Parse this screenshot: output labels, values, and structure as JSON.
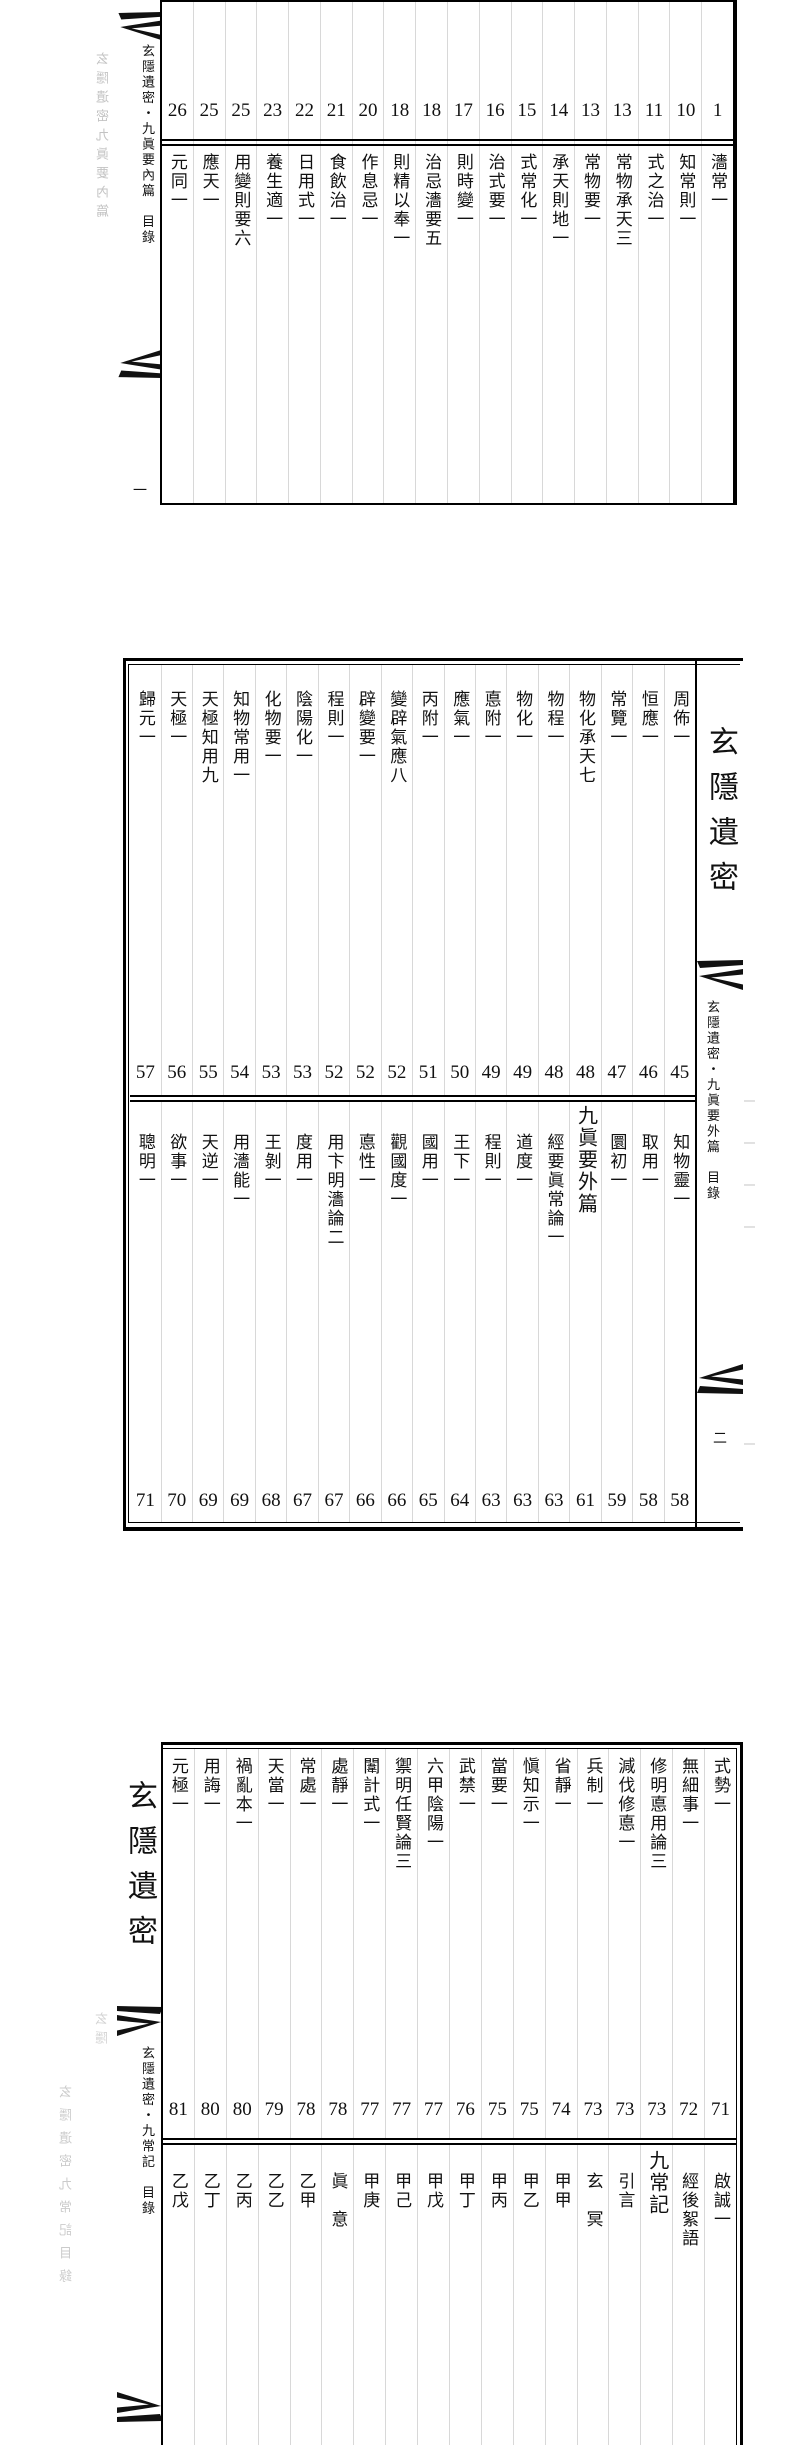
{
  "page": {
    "background": "#ffffff",
    "ink_color": "#111111",
    "grid_color": "#d8d8d8"
  },
  "section1": {
    "fold": {
      "title": "玄隱遺密・九眞要內篇　目錄",
      "folio": "一",
      "ghost_text": "玄隱遺密九眞要內篇"
    },
    "entries": [
      {
        "page": "1",
        "title": "瀒常一"
      },
      {
        "page": "10",
        "title": "知常則一"
      },
      {
        "page": "11",
        "title": "式之治一"
      },
      {
        "page": "13",
        "title": "常物承天三"
      },
      {
        "page": "13",
        "title": "常物要一"
      },
      {
        "page": "14",
        "title": "承天則地一"
      },
      {
        "page": "15",
        "title": "式常化一"
      },
      {
        "page": "16",
        "title": "治式要一"
      },
      {
        "page": "17",
        "title": "則時變一"
      },
      {
        "page": "18",
        "title": "治忌瀒要五"
      },
      {
        "page": "18",
        "title": "則精以奉一"
      },
      {
        "page": "20",
        "title": "作息忌一"
      },
      {
        "page": "21",
        "title": "食飲治一"
      },
      {
        "page": "22",
        "title": "日用式一"
      },
      {
        "page": "23",
        "title": "養生適一"
      },
      {
        "page": "25",
        "title": "用變則要六"
      },
      {
        "page": "25",
        "title": "應天一"
      },
      {
        "page": "26",
        "title": "元同一"
      }
    ]
  },
  "section2": {
    "big_title": "玄隱遺密",
    "fold": {
      "title": "玄隱遺密・九眞要外篇　目錄",
      "folio": "二",
      "ghost_text": "一一一一",
      "ghost_text2": "一"
    },
    "upper_entries": [
      {
        "page": "45",
        "title": "周佈一"
      },
      {
        "page": "46",
        "title": "恒應一"
      },
      {
        "page": "47",
        "title": "常覽一"
      },
      {
        "page": "48",
        "title": "物化承天七"
      },
      {
        "page": "48",
        "title": "物程一"
      },
      {
        "page": "49",
        "title": "物化一"
      },
      {
        "page": "49",
        "title": "悳附一"
      },
      {
        "page": "50",
        "title": "應氣一"
      },
      {
        "page": "51",
        "title": "丙附一"
      },
      {
        "page": "52",
        "title": "變辟氣應八"
      },
      {
        "page": "52",
        "title": "辟變要一"
      },
      {
        "page": "52",
        "title": "程則一"
      },
      {
        "page": "53",
        "title": "陰陽化一"
      },
      {
        "page": "53",
        "title": "化物要一"
      },
      {
        "page": "54",
        "title": "知物常用一"
      },
      {
        "page": "55",
        "title": "天極知用九"
      },
      {
        "page": "56",
        "title": "天極一"
      },
      {
        "page": "57",
        "title": "歸元一"
      }
    ],
    "lower_entries": [
      {
        "page": "58",
        "title": "知物靈一"
      },
      {
        "page": "58",
        "title": "取用一"
      },
      {
        "page": "59",
        "title": "圜初一"
      },
      {
        "page": "61",
        "title": "九眞要外篇",
        "large": true
      },
      {
        "page": "63",
        "title": "經要眞常論一"
      },
      {
        "page": "63",
        "title": "道度一"
      },
      {
        "page": "63",
        "title": "程則一"
      },
      {
        "page": "64",
        "title": "王下一"
      },
      {
        "page": "65",
        "title": "國用一"
      },
      {
        "page": "66",
        "title": "觀國度一"
      },
      {
        "page": "66",
        "title": "悳性一"
      },
      {
        "page": "67",
        "title": "用卞明瀒論二"
      },
      {
        "page": "67",
        "title": "度用一"
      },
      {
        "page": "68",
        "title": "王剝一"
      },
      {
        "page": "69",
        "title": "用瀒能一"
      },
      {
        "page": "69",
        "title": "天逆一"
      },
      {
        "page": "70",
        "title": "欲事一"
      },
      {
        "page": "71",
        "title": "聰明一"
      }
    ]
  },
  "section3": {
    "big_title": "玄隱遺密",
    "fold": {
      "title": "玄隱遺密・九常記　目錄",
      "ghost_text": "玄隱遺密九常記目錄",
      "ghost_text2": "玄隱"
    },
    "upper_entries": [
      {
        "page": "71",
        "title": "式勢一"
      },
      {
        "page": "72",
        "title": "無細事一"
      },
      {
        "page": "73",
        "title": "修明悳用論三"
      },
      {
        "page": "73",
        "title": "減伐修悳一"
      },
      {
        "page": "73",
        "title": "兵制一"
      },
      {
        "page": "74",
        "title": "省靜一"
      },
      {
        "page": "75",
        "title": "愼知示一"
      },
      {
        "page": "75",
        "title": "當要一"
      },
      {
        "page": "76",
        "title": "武禁一"
      },
      {
        "page": "77",
        "title": "六甲陰陽一"
      },
      {
        "page": "77",
        "title": "禦明任賢論三"
      },
      {
        "page": "77",
        "title": "闈計式一"
      },
      {
        "page": "78",
        "title": "處靜一"
      },
      {
        "page": "78",
        "title": "常處一"
      },
      {
        "page": "79",
        "title": "天當一"
      },
      {
        "page": "80",
        "title": "禍亂本一"
      },
      {
        "page": "80",
        "title": "用誨一"
      },
      {
        "page": "81",
        "title": "元極一"
      }
    ],
    "lower_entries": [
      {
        "title": "啟誠一"
      },
      {
        "title": "經後絮語"
      },
      {
        "title": "九常記",
        "large": true
      },
      {
        "title": "引言"
      },
      {
        "title": "玄　冥"
      },
      {
        "title": "甲甲"
      },
      {
        "title": "甲乙"
      },
      {
        "title": "甲丙"
      },
      {
        "title": "甲丁"
      },
      {
        "title": "甲戊"
      },
      {
        "title": "甲己"
      },
      {
        "title": "甲庚"
      },
      {
        "title": "眞　意"
      },
      {
        "title": "乙甲"
      },
      {
        "title": "乙乙"
      },
      {
        "title": "乙丙"
      },
      {
        "title": "乙丁"
      },
      {
        "title": "乙戊"
      }
    ]
  }
}
